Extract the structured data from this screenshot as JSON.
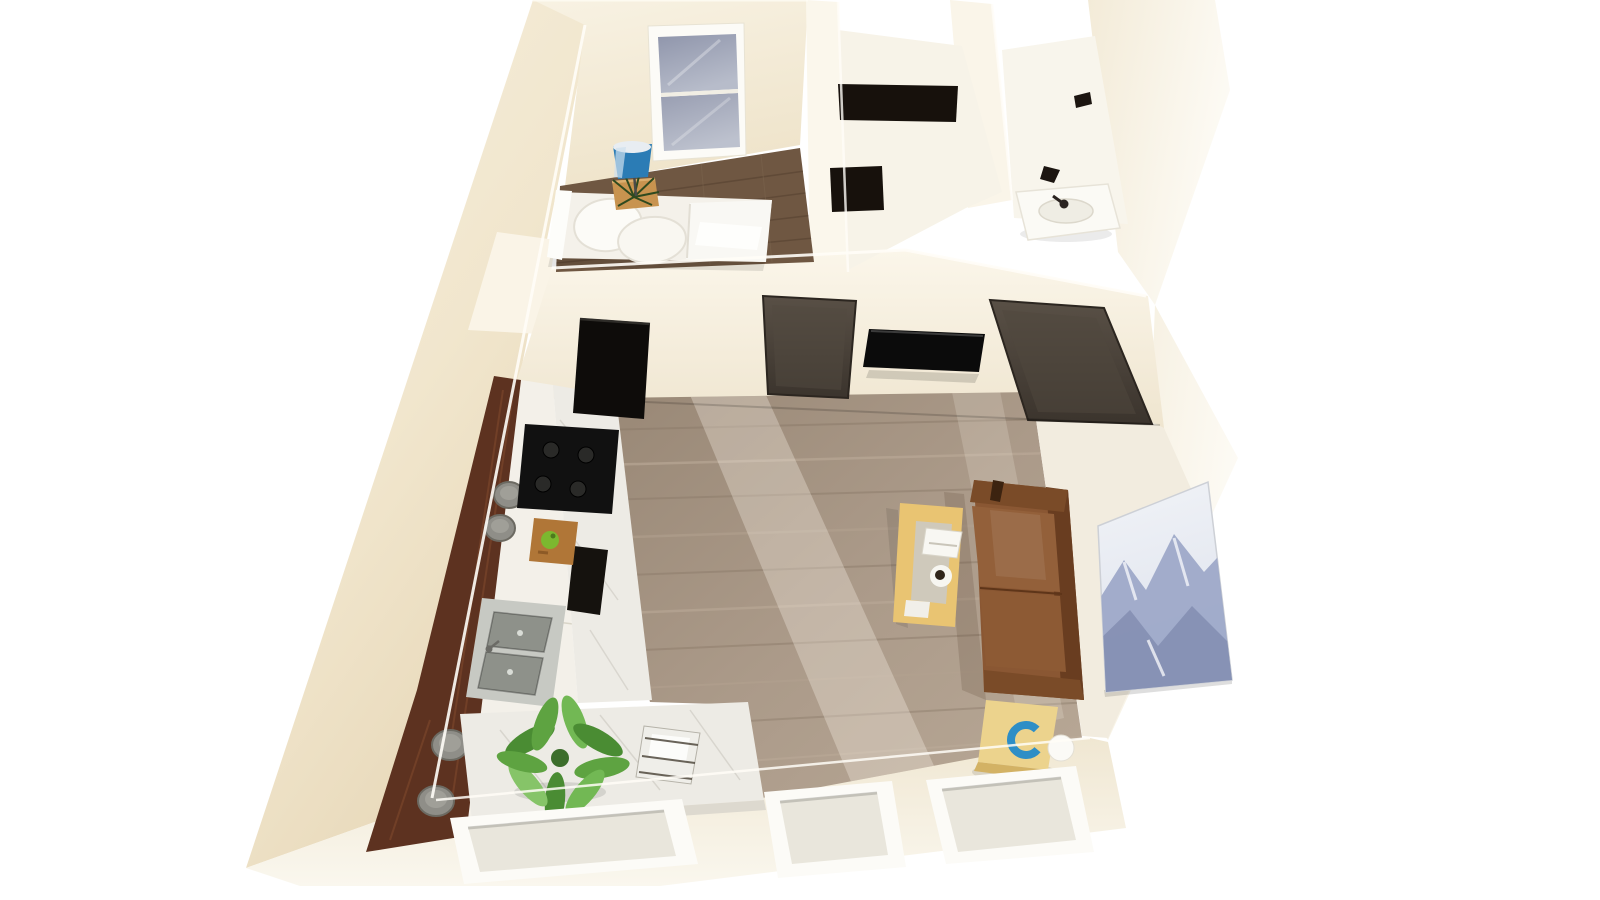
{
  "scene": {
    "title": "3D top-down rendering of a studio apartment floor plan",
    "view": "dollhouse bird's-eye perspective, no visible text",
    "rooms": [
      {
        "id": "bedroom",
        "label": "Bedroom"
      },
      {
        "id": "closet",
        "label": "Closet hall"
      },
      {
        "id": "bathroom",
        "label": "Bathroom"
      },
      {
        "id": "living",
        "label": "Living room"
      },
      {
        "id": "kitchen",
        "label": "Kitchen"
      }
    ],
    "furniture": [
      {
        "id": "bed",
        "label": "Bed with white bedding and pillows"
      },
      {
        "id": "nightstand",
        "label": "Wood nightstand with plant"
      },
      {
        "id": "floor-lamp",
        "label": "Blue floor lamp"
      },
      {
        "id": "bedroom-window",
        "label": "Window with gray glass"
      },
      {
        "id": "wardrobe",
        "label": "Black wardrobe shelves"
      },
      {
        "id": "bathroom-sink",
        "label": "White bathroom sink with faucet"
      },
      {
        "id": "door-left",
        "label": "Dark interior door"
      },
      {
        "id": "tv",
        "label": "Wall mounted TV"
      },
      {
        "id": "door-right",
        "label": "Dark interior door"
      },
      {
        "id": "sofa",
        "label": "Brown leather sofa"
      },
      {
        "id": "coffee-table",
        "label": "Yellow coffee table with tray and cup"
      },
      {
        "id": "side-table",
        "label": "Yellow side table with blue bowl and white sphere"
      },
      {
        "id": "artwork",
        "label": "Mountain artwork leaning on floor"
      },
      {
        "id": "bar-counter",
        "label": "Dark walnut bar strip"
      },
      {
        "id": "bar-stools",
        "label": "Round gray bar stools"
      },
      {
        "id": "refrigerator",
        "label": "Black refrigerator"
      },
      {
        "id": "cooktop",
        "label": "Black cooktop with burners"
      },
      {
        "id": "kitchen-sink",
        "label": "Stainless double basin sink"
      },
      {
        "id": "cutting-board",
        "label": "Cutting board with green apple"
      },
      {
        "id": "island",
        "label": "Marble kitchen island"
      },
      {
        "id": "island-plant",
        "label": "Green potted plant"
      },
      {
        "id": "basket",
        "label": "Wire basket with napkins"
      },
      {
        "id": "bottom-windows",
        "label": "Three white framed windows in south wall"
      }
    ],
    "colors": {
      "background": "#ffffff",
      "wall": "#f4ecda",
      "wall_shadow": "#e7d9bd",
      "wall_top": "#fbf7ec",
      "floor_living": "#a89786",
      "floor_bedroom": "#6f5742",
      "floor_light": "#f2ecdf",
      "hall_floor": "#f7f3e8",
      "bath_floor": "#f8f5ec",
      "bar_wood": "#5d3220",
      "stool": "#8f8e88",
      "stool_top": "#a09f98",
      "cabinet": "#f3f0e9",
      "marble": "#edebe5",
      "stove": "#111111",
      "fridge": "#0e0c0a",
      "panel": "#15120e",
      "sink_steel": "#c7c9c3",
      "sink_basin": "#8e918a",
      "cutting_board": "#b07637",
      "apple": "#7cb82f",
      "plant": "#5ea341",
      "plant_dark": "#3c6e2b",
      "bed": "#f4f1ea",
      "pillow": "#fcfbf7",
      "headboard": "#fdfdfa",
      "nightstand": "#c8934f",
      "lamp_blue": "#2b7cb5",
      "door": "#48403a",
      "tv": "#0b0b0b",
      "wardrobe": "#17110c",
      "hook": "#1c1510",
      "sofa": "#8a5733",
      "sofa_dark": "#693d20",
      "sofa_arm": "#7a4b28",
      "sofa_cushion": "#93603a",
      "coffee_table": "#e9c472",
      "runner": "#cfc9bb",
      "tray": "#f8f7f2",
      "cup_dark": "#30261b",
      "side_table": "#ecd38d",
      "accent_blue": "#2e8ec6",
      "sphere_white": "#fbfaf6",
      "art_ridge_light": "#9aa5c6",
      "art_ridge_dark": "#7f8aad",
      "window_frame": "#fcfbf7",
      "window_recess": "#e9e6dc",
      "basket_fill": "#efeee9"
    }
  }
}
